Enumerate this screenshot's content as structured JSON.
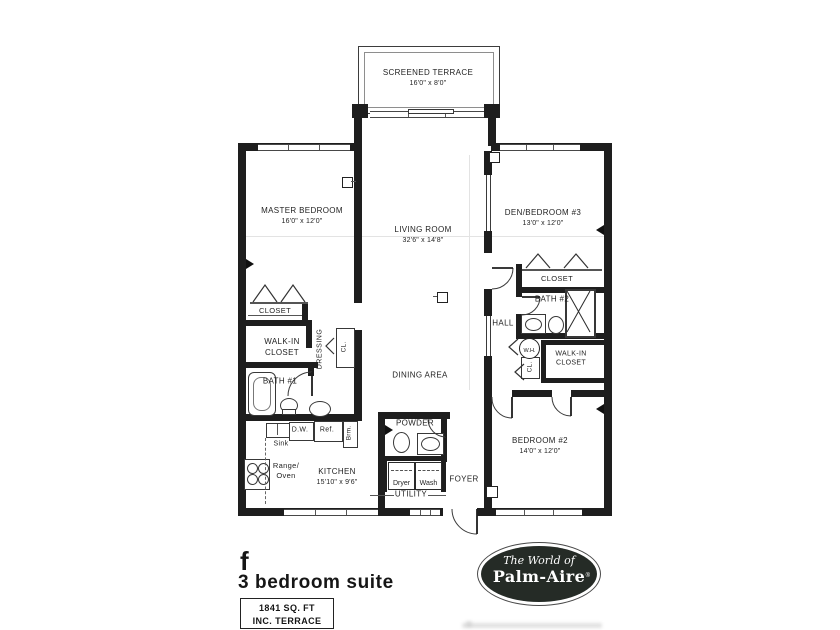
{
  "title_block": {
    "plan_letter": "f",
    "plan_name": "3 bedroom suite",
    "area_sqft": "1841 SQ. FT",
    "area_note": "INC. TERRACE"
  },
  "logo": {
    "tagline": "The World of",
    "brand": "Palm-Aire",
    "registered_mark": "®"
  },
  "rooms": {
    "terrace": {
      "name": "SCREENED TERRACE",
      "dims": "16'0\" x 8'0\""
    },
    "master_bedroom": {
      "name": "MASTER BEDROOM",
      "dims": "16'0\" x 12'0\""
    },
    "living_room": {
      "name": "LIVING ROOM",
      "dims": "32'6\" x 14'8\""
    },
    "den_bedroom3": {
      "name": "DEN/BEDROOM #3",
      "dims": "13'0\" x 12'0\""
    },
    "bedroom2": {
      "name": "BEDROOM #2",
      "dims": "14'0\" x 12'0\""
    },
    "kitchen": {
      "name": "KITCHEN",
      "dims": "15'10\" x 9'6\""
    },
    "dining_area": "DINING AREA",
    "foyer": "FOYER",
    "utility": "UTILITY",
    "powder": "POWDER",
    "hall": "HALL",
    "dressing": "DRESSING",
    "bath1": "BATH #1",
    "bath2": "BATH #2",
    "closet_master": "CLOSET",
    "walkin_master_line1": "WALK-IN",
    "walkin_master_line2": "CLOSET",
    "closet_den": "CLOSET",
    "walkin_bed2_line1": "WALK-IN",
    "walkin_bed2_line2": "CLOSET",
    "cl_master": "CL.",
    "cl_hall": "CL."
  },
  "fixtures": {
    "sink": "Sink",
    "dishwasher": "D.W.",
    "refrigerator": "Ref.",
    "broom": "Brm.",
    "range_line1": "Range/",
    "range_line2": "Oven",
    "dryer": "Dryer",
    "washer": "Wash",
    "water_heater": "W.H."
  },
  "colors": {
    "wall": "#1e1e1e",
    "line": "#4f4f4f",
    "paper": "#ffffff",
    "logo_bg": "#252b26"
  }
}
